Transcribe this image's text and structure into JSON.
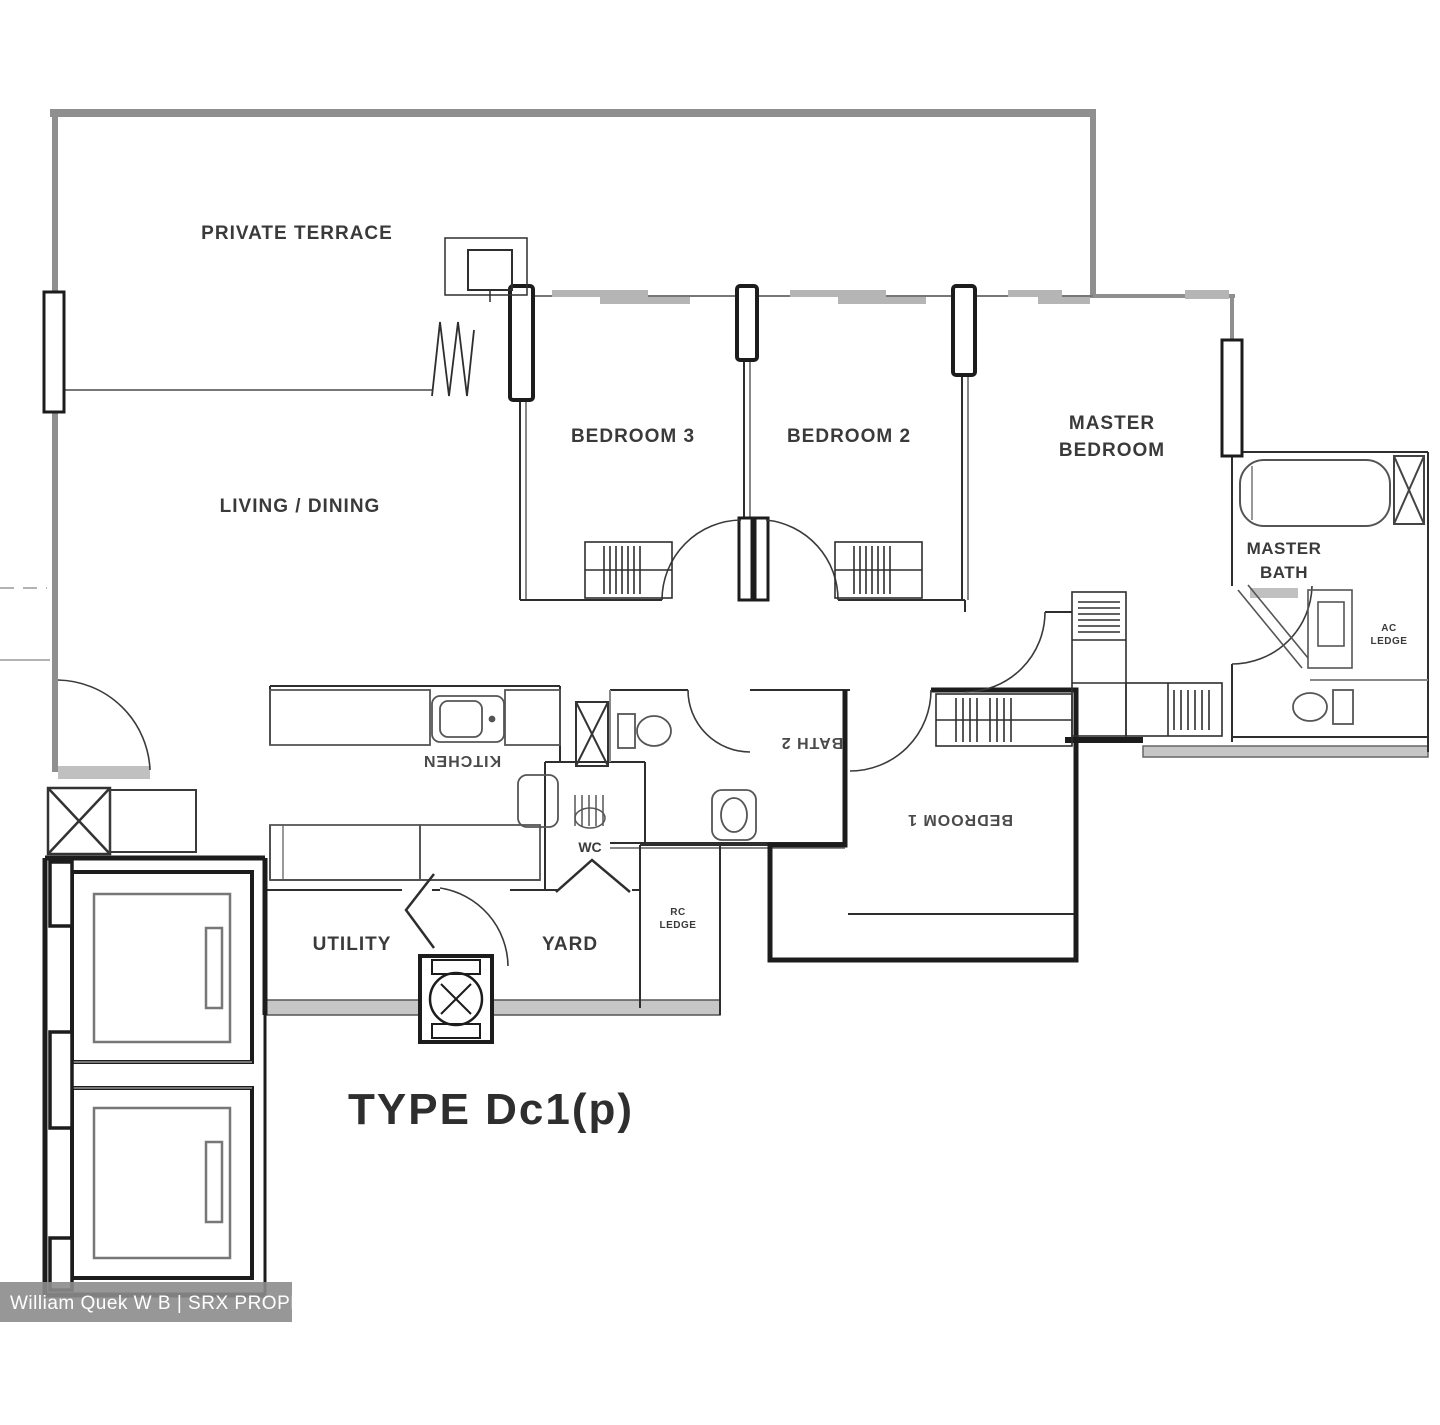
{
  "floor_plan": {
    "labels": {
      "private_terrace": "PRIVATE TERRACE",
      "living_dining": "LIVING / DINING",
      "bedroom3": "BEDROOM 3",
      "bedroom2": "BEDROOM 2",
      "master_bedroom": {
        "line1": "MASTER",
        "line2": "BEDROOM"
      },
      "master_bath": {
        "line1": "MASTER",
        "line2": "BATH"
      },
      "ac_ledge": {
        "line1": "AC",
        "line2": "LEDGE"
      },
      "rc_ledge": {
        "line1": "RC",
        "line2": "LEDGE"
      },
      "kitchen": "KITCHEN",
      "bath2": "BATH 2",
      "bedroom1": "BEDROOM 1",
      "wc": "WC",
      "utility": "UTILITY",
      "yard": "YARD"
    },
    "title": {
      "type_label": "TYPE Dc1(p)"
    },
    "watermark": {
      "text": "William Quek W B | SRX PROPERTY"
    },
    "colors": {
      "exterior_wall": "#8f8f8f",
      "interior_line": "#2e2e2e",
      "window_slab": "#b5b5b5",
      "watermark_bg": "#8c8c8c",
      "watermark_text": "#ffffff"
    }
  }
}
